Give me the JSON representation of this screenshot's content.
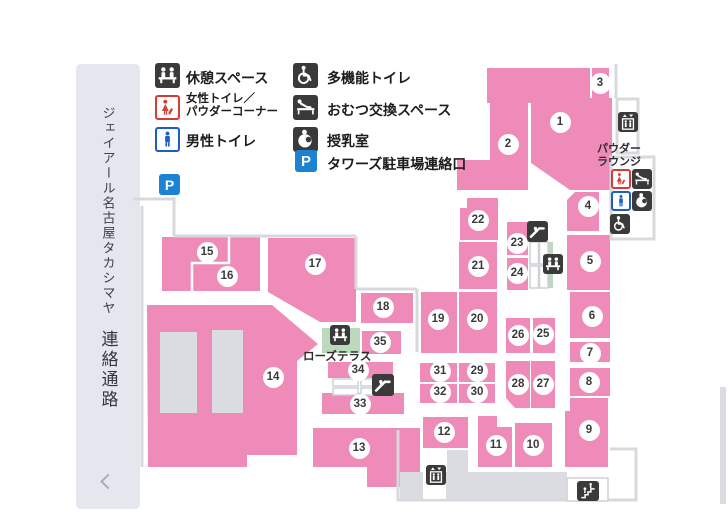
{
  "sidebar": {
    "title_vertical": "ジェイアール名古屋タカシマヤ",
    "subtitle_vertical": "連絡通路"
  },
  "legend": {
    "items": [
      {
        "icon": "rest-space-icon",
        "label": "休憩スペース"
      },
      {
        "icon": "female-toilet-icon",
        "label": "女性トイレ／",
        "label2": "パウダーコーナー"
      },
      {
        "icon": "male-toilet-icon",
        "label": "男性トイレ"
      },
      {
        "icon": "accessible-toilet-icon",
        "label": "多機能トイレ"
      },
      {
        "icon": "diaper-change-icon",
        "label": "おむつ交換スペース"
      },
      {
        "icon": "nursing-room-icon",
        "label": "授乳室"
      },
      {
        "icon": "tower-parking-icon",
        "label": "タワーズ駐車場連絡口"
      }
    ]
  },
  "icons": {
    "parking_letter": "P"
  },
  "map": {
    "areas": [
      "1",
      "2",
      "3",
      "4",
      "5",
      "6",
      "7",
      "8",
      "9",
      "10",
      "11",
      "12",
      "13",
      "14",
      "15",
      "16",
      "17",
      "18",
      "19",
      "20",
      "21",
      "22",
      "23",
      "24",
      "25",
      "26",
      "27",
      "28",
      "29",
      "30",
      "31",
      "32",
      "33",
      "34",
      "35"
    ],
    "labels": {
      "powder_lounge_line1": "パウダー",
      "powder_lounge_line2": "ラウンジ",
      "rose_terrace": "ローズテラス"
    },
    "colors": {
      "area_pink": "#ee8bb8",
      "walkway_outline": "#d8d9dd",
      "corridor_gray": "#dadce1",
      "terrace_green": "#bcd8bd",
      "icon_dark": "#3a3a3a",
      "parking_blue": "#1e82d2",
      "male_blue": "#1e5ec4",
      "female_red": "#d93a31",
      "sidebar_gray": "#e4e7ed"
    }
  }
}
